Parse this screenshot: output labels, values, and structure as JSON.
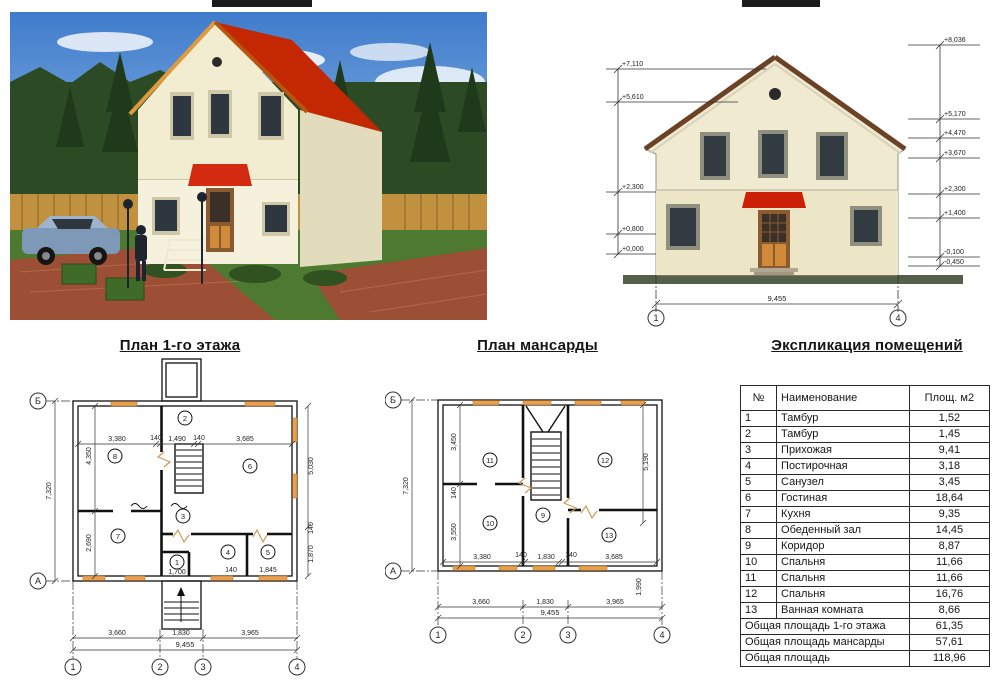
{
  "titles": {
    "floor1": "План 1-го этажа",
    "attic": "План мансарды",
    "explication": "Экспликация помещений"
  },
  "facade": {
    "marks_left": [
      "+7,110",
      "+5,610",
      "+2,300",
      "+0,800",
      "+0,000"
    ],
    "marks_right": [
      "+8,036",
      "+5,170",
      "+4,470",
      "+3,670",
      "+2,300",
      "+1,400",
      "-0,100",
      "-0,450"
    ],
    "width": "9,455",
    "axis_left": "1",
    "axis_right": "4"
  },
  "plan1": {
    "total_height": "7,320",
    "total_width": "9,455",
    "left_inner": [
      "4,350",
      "2,690"
    ],
    "top_inner": [
      "3,380",
      "140",
      "1,490",
      "140",
      "3,685"
    ],
    "right_inner": [
      "5,030",
      "140",
      "1,870"
    ],
    "bottom_inner": [
      "1,700",
      "140",
      "1,845"
    ],
    "bottom": [
      "3,660",
      "1,830",
      "3,965"
    ],
    "axes": [
      "1",
      "2",
      "3",
      "4"
    ],
    "rows": [
      "Б",
      "А"
    ],
    "rooms": [
      "1",
      "2",
      "3",
      "4",
      "5",
      "6",
      "7",
      "8"
    ]
  },
  "attic": {
    "total_height": "7,320",
    "total_width": "9,455",
    "left_inner": [
      "3,450",
      "140",
      "3,550"
    ],
    "right_inner": [
      "5,190",
      "1,990"
    ],
    "bottom_inner": [
      "3,380",
      "140",
      "1,830",
      "140",
      "3,685"
    ],
    "bottom": [
      "3,660",
      "1,830",
      "3,965"
    ],
    "axes": [
      "1",
      "2",
      "3",
      "4"
    ],
    "rows": [
      "Б",
      "А"
    ],
    "rooms": [
      "9",
      "10",
      "11",
      "12",
      "13"
    ]
  },
  "table": {
    "headers": [
      "№",
      "Наименование",
      "Площ. м2"
    ],
    "rows": [
      [
        "1",
        "Тамбур",
        "1,52"
      ],
      [
        "2",
        "Тамбур",
        "1,45"
      ],
      [
        "3",
        "Прихожая",
        "9,41"
      ],
      [
        "4",
        "Постирочная",
        "3,18"
      ],
      [
        "5",
        "Санузел",
        "3,45"
      ],
      [
        "6",
        "Гостиная",
        "18,64"
      ],
      [
        "7",
        "Кухня",
        "9,35"
      ],
      [
        "8",
        "Обеденный зал",
        "14,45"
      ],
      [
        "9",
        "Коридор",
        "8,87"
      ],
      [
        "10",
        "Спальня",
        "11,66"
      ],
      [
        "11",
        "Спальня",
        "11,66"
      ],
      [
        "12",
        "Спальня",
        "16,76"
      ],
      [
        "13",
        "Ванная комната",
        "8,66"
      ]
    ],
    "totals": [
      {
        "label": "Общая площадь 1-го этажа",
        "value": "61,35"
      },
      {
        "label": "Общая площадь мансарды",
        "value": "57,61"
      },
      {
        "label": "Общая площадь",
        "value": "118,96"
      }
    ]
  },
  "colors": {
    "roof_red": "#c32803",
    "window_marker": "#e8a050",
    "awning_red": "#cc1f08"
  }
}
